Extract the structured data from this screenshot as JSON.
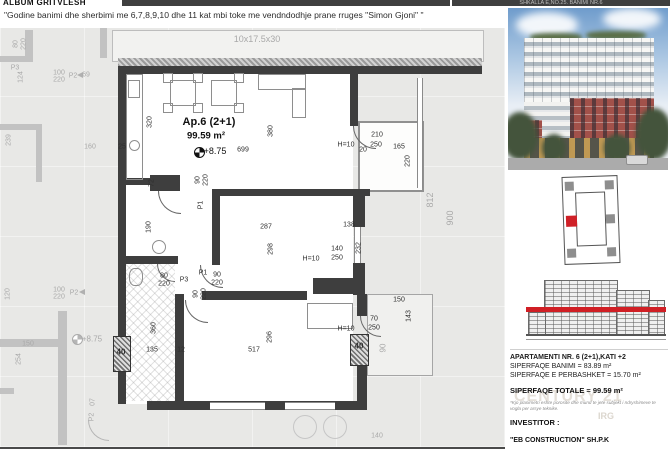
{
  "header": {
    "album_label": "ALBUM GRITVLESH",
    "sheet_label": "SHKALLA E,NO.25. BANIMI NR.6",
    "subtitle": "\"Godine banimi dhe sherbimi me 6,7,8,9,10 dhe 11 kat mbi toke me vendndodhje prane rruges \"Simon Gjoni\" \""
  },
  "plan": {
    "apartment_label": "Ap.6 (2+1)",
    "area_label": "99.59 m²",
    "level_label": "+8.75",
    "stair_label": "10x17.5x30",
    "dims": [
      {
        "t": "320",
        "x": 150,
        "y": 94,
        "v": true
      },
      {
        "t": "699",
        "x": 243,
        "y": 122
      },
      {
        "t": "380",
        "x": 271,
        "y": 103,
        "v": true
      },
      {
        "t": "210",
        "x": 377,
        "y": 107
      },
      {
        "t": "250",
        "x": 376,
        "y": 117
      },
      {
        "t": "H=10",
        "x": 346,
        "y": 117
      },
      {
        "t": "20",
        "x": 363,
        "y": 122
      },
      {
        "t": "165",
        "x": 399,
        "y": 119
      },
      {
        "t": "220",
        "x": 408,
        "y": 133,
        "v": true
      },
      {
        "t": "72",
        "x": 152,
        "y": 155,
        "v": true
      },
      {
        "t": "90",
        "x": 198,
        "y": 152,
        "v": true
      },
      {
        "t": "220",
        "x": 206,
        "y": 152,
        "v": true
      },
      {
        "t": "P1",
        "x": 201,
        "y": 177,
        "v": true
      },
      {
        "t": "190",
        "x": 149,
        "y": 199,
        "v": true
      },
      {
        "t": "287",
        "x": 266,
        "y": 199
      },
      {
        "t": "298",
        "x": 271,
        "y": 221,
        "v": true
      },
      {
        "t": "H=10",
        "x": 311,
        "y": 231
      },
      {
        "t": "138",
        "x": 349,
        "y": 197
      },
      {
        "t": "232",
        "x": 359,
        "y": 220,
        "v": true
      },
      {
        "t": "140",
        "x": 337,
        "y": 221
      },
      {
        "t": "250",
        "x": 337,
        "y": 230
      },
      {
        "t": "80",
        "x": 164,
        "y": 248
      },
      {
        "t": "220",
        "x": 164,
        "y": 256
      },
      {
        "t": "P3",
        "x": 184,
        "y": 252
      },
      {
        "t": "P1",
        "x": 203,
        "y": 245
      },
      {
        "t": "90",
        "x": 217,
        "y": 247
      },
      {
        "t": "220",
        "x": 217,
        "y": 255
      },
      {
        "t": "360",
        "x": 154,
        "y": 300,
        "v": true
      },
      {
        "t": "135",
        "x": 152,
        "y": 322
      },
      {
        "t": "12",
        "x": 181,
        "y": 322
      },
      {
        "t": "517",
        "x": 254,
        "y": 322
      },
      {
        "t": "296",
        "x": 270,
        "y": 309,
        "v": true
      },
      {
        "t": "90",
        "x": 196,
        "y": 266,
        "v": true
      },
      {
        "t": "220",
        "x": 204,
        "y": 266,
        "v": true
      },
      {
        "t": "150",
        "x": 399,
        "y": 272
      },
      {
        "t": "143",
        "x": 409,
        "y": 288,
        "v": true
      },
      {
        "t": "70",
        "x": 374,
        "y": 291
      },
      {
        "t": "250",
        "x": 374,
        "y": 300
      },
      {
        "t": "H=10",
        "x": 346,
        "y": 301
      },
      {
        "t": "40",
        "x": 121,
        "y": 324,
        "b": true,
        "s": 8
      },
      {
        "t": "40",
        "x": 359,
        "y": 318,
        "b": true,
        "s": 8
      },
      {
        "t": "90",
        "x": 383,
        "y": 320,
        "v": true,
        "f": true,
        "s": 8
      },
      {
        "t": "812",
        "x": 430,
        "y": 172,
        "v": true,
        "f": true,
        "s": 9
      },
      {
        "t": "900",
        "x": 450,
        "y": 190,
        "v": true,
        "f": true,
        "s": 9
      },
      {
        "t": "140",
        "x": 377,
        "y": 408,
        "f": true
      },
      {
        "t": "80",
        "x": 16,
        "y": 16,
        "v": true,
        "f": true
      },
      {
        "t": "220",
        "x": 24,
        "y": 16,
        "v": true,
        "f": true
      },
      {
        "t": "P3",
        "x": 15,
        "y": 40,
        "f": true
      },
      {
        "t": "124",
        "x": 21,
        "y": 49,
        "v": true,
        "f": true
      },
      {
        "t": "100",
        "x": 59,
        "y": 45,
        "f": true
      },
      {
        "t": "220",
        "x": 59,
        "y": 52,
        "f": true
      },
      {
        "t": "P2",
        "x": 73,
        "y": 48,
        "f": true
      },
      {
        "t": "69",
        "x": 86,
        "y": 47,
        "f": true
      },
      {
        "t": "239",
        "x": 9,
        "y": 112,
        "v": true,
        "f": true
      },
      {
        "t": "160",
        "x": 90,
        "y": 119,
        "f": true
      },
      {
        "t": "25",
        "x": 122,
        "y": 119
      },
      {
        "t": "120",
        "x": 8,
        "y": 266,
        "v": true,
        "f": true
      },
      {
        "t": "100",
        "x": 59,
        "y": 262,
        "f": true
      },
      {
        "t": "220",
        "x": 59,
        "y": 269,
        "f": true
      },
      {
        "t": "P2",
        "x": 74,
        "y": 265,
        "f": true
      },
      {
        "t": "+8.75",
        "x": 92,
        "y": 311,
        "f": true,
        "s": 8
      },
      {
        "t": "150",
        "x": 28,
        "y": 316,
        "f": true
      },
      {
        "t": "254",
        "x": 19,
        "y": 331,
        "v": true,
        "f": true
      },
      {
        "t": "07",
        "x": 93,
        "y": 374,
        "v": true,
        "f": true
      },
      {
        "t": "P2",
        "x": 92,
        "y": 389,
        "v": true,
        "f": true
      }
    ]
  },
  "sidebar": {
    "info": {
      "line1": "APARTAMENTI NR. 6 (2+1),KATI +2",
      "line2": "SIPERFAQE BANIMI = 83.89 m²",
      "line3": "SIPERFAQE E PERBASHKET = 15.70 m²",
      "total": "SIPERFAQE TOTALE = 99.59 m²",
      "note": "*Kjo planimetri eshte porosite dhe mund te jete subjekt i ndryshimeve te vogla per arsye teknike.",
      "investor_label": "INVESTITOR :",
      "investor_name": "\"EB CONSTRUCTION\" SH.P.K"
    },
    "watermark": {
      "line1": "CENTURY 21",
      "line2": "IRG"
    }
  },
  "colors": {
    "wall": "#3e3e3e",
    "accent_red": "#cf2027",
    "plan_background": "#e8e8e6",
    "brick": "#a2514a"
  }
}
